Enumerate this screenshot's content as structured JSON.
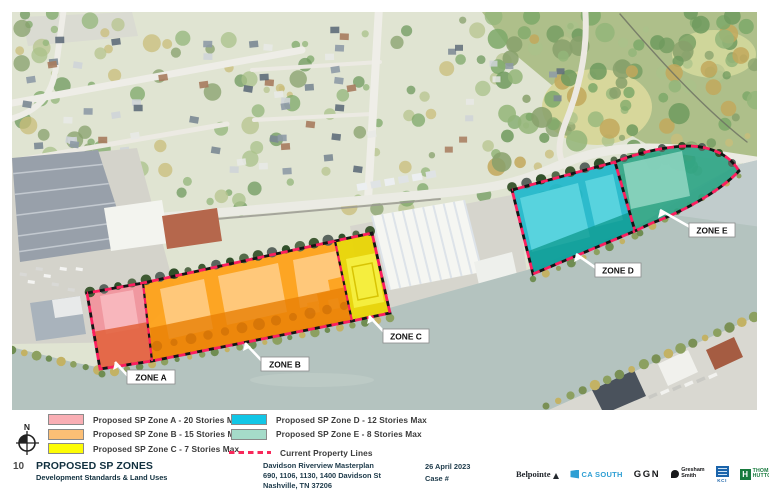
{
  "map": {
    "zones": [
      {
        "id": "A",
        "label": "ZONE A",
        "color": "#F2929C"
      },
      {
        "id": "B",
        "label": "ZONE B",
        "color": "#FFA013"
      },
      {
        "id": "C",
        "label": "ZONE C",
        "color": "#E9D504"
      },
      {
        "id": "D",
        "label": "ZONE D",
        "color": "#1DB7CB"
      },
      {
        "id": "E",
        "label": "ZONE E",
        "color": "#2AA384"
      }
    ],
    "property_line_color": "#FB1E5E"
  },
  "legend": {
    "north_label": "N",
    "items": [
      {
        "label": "Proposed SP Zone A - 20 Stories Max",
        "swatch": "#F9AEB4"
      },
      {
        "label": "Proposed SP Zone B - 15 Stories Max",
        "swatch": "#FCBF75"
      },
      {
        "label": "Proposed SP Zone C - 7 Stories Max",
        "swatch": "#FDFC05"
      },
      {
        "label": "Proposed SP Zone D - 12 Stories Max",
        "swatch": "#12C6E6"
      },
      {
        "label": "Proposed SP Zone E -  8 Stories Max",
        "swatch": "#A5DBC9"
      },
      {
        "label": "Current Property Lines",
        "swatch": "dashed"
      }
    ]
  },
  "footer": {
    "page_number": "10",
    "title": "PROPOSED SP ZONES",
    "subtitle": "Development Standards & Land Uses",
    "project_name": "Davidson Riverview Masterplan",
    "project_address": "690, 1106, 1130, 1400 Davidson St",
    "project_city": "Nashville, TN 37206",
    "date": "26 April 2023",
    "case_number": "Case #",
    "logos": {
      "belpointe": "Belpointe",
      "ca_south": "CA SOUTH",
      "ggn": "GGN",
      "gresham_line1": "Gresham",
      "gresham_line2": "Smith",
      "kci": "KCI",
      "th_line1": "THOMAS",
      "th_line2": "HUTTON"
    }
  }
}
